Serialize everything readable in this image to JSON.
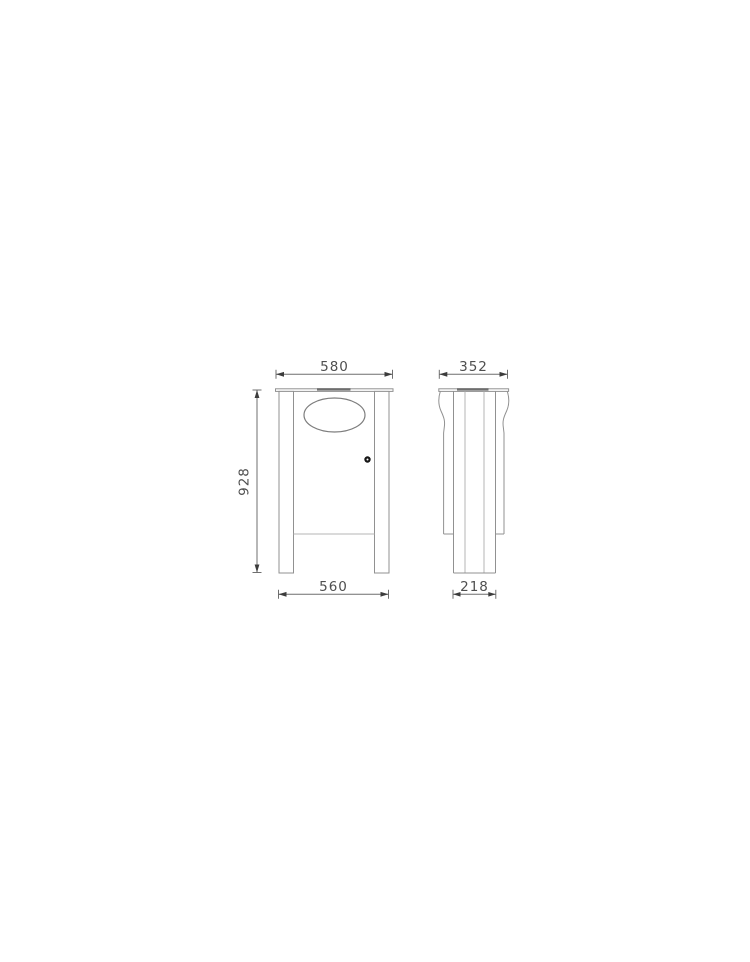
{
  "drawing": {
    "kind": "technical-drawing-litter-bin",
    "views": {
      "front": {
        "name": "front-view"
      },
      "side": {
        "name": "side-view"
      }
    },
    "dimensions": {
      "top_width": "580",
      "top_depth": "352",
      "height": "928",
      "bottom_width": "560",
      "bottom_depth": "218"
    },
    "colors": {
      "background": "#ffffff",
      "line": "#919191",
      "light_line": "#b4b4b4",
      "lid_strip": "#6e6e6e",
      "dimension_line": "#6f6f6f",
      "dimension_text": "#4f4f4f",
      "lock": "#161616"
    }
  }
}
